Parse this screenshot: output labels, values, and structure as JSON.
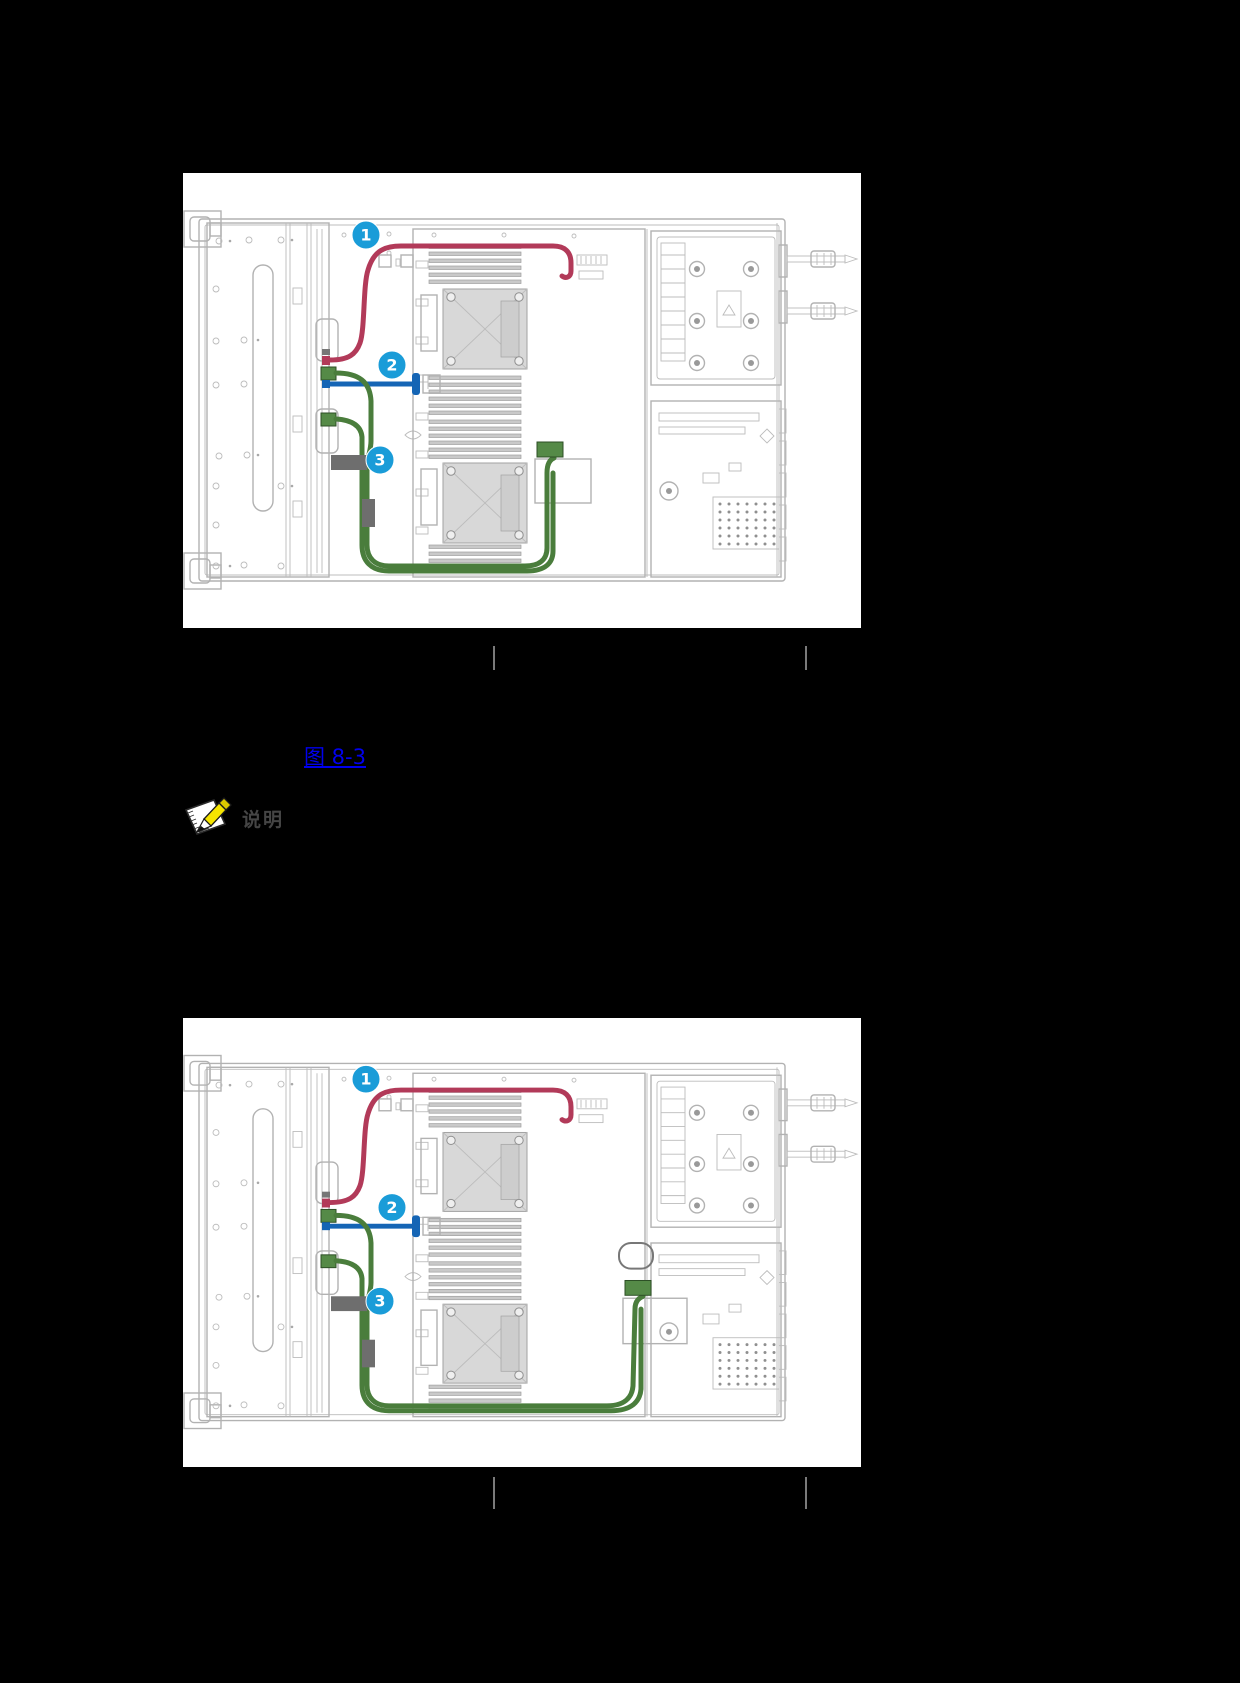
{
  "page": {
    "background": "#000000",
    "panel_background": "#ffffff"
  },
  "figure1": {
    "callouts": [
      "1",
      "2",
      "3"
    ]
  },
  "figure2": {
    "callouts": [
      "1",
      "2",
      "3"
    ]
  },
  "link": {
    "text": "图 8-3"
  },
  "note": {
    "label": "说明"
  },
  "icons": {
    "note_icon": "notepad-pencil-icon"
  },
  "colors": {
    "cable_red": "#b23a59",
    "cable_blue": "#1565b5",
    "cable_green": "#4a7d3c",
    "cable_green_fill": "#558a47",
    "callout_blue": "#1a9cd8",
    "link_blue": "#0000ee",
    "note_text": "#454545",
    "separator_gray": "#7a7a7a",
    "line_gray": "#b2b2b2",
    "clip_gray": "#6e6e6e"
  }
}
